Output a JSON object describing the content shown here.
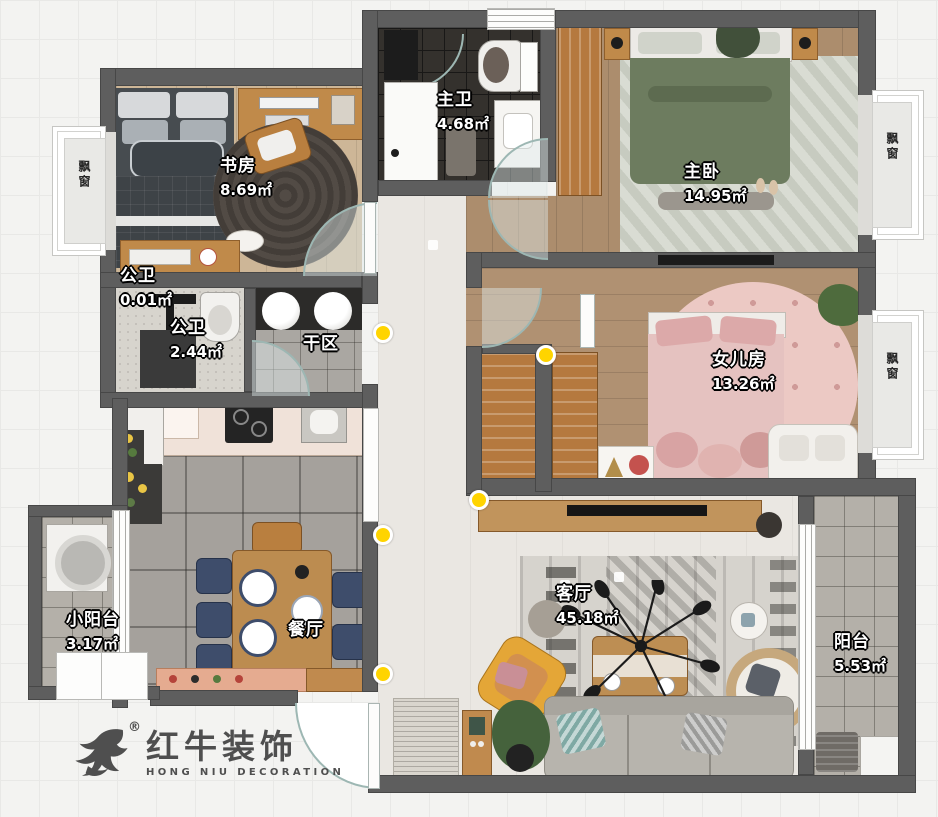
{
  "colors": {
    "wall": "#5e5e5e",
    "accent_dot": "#ffd400",
    "logo": "#4f4f4f",
    "door_glass": "#9db7b3"
  },
  "logo": {
    "brand_cn": "红牛装饰",
    "brand_en": "HONG NIU DECORATION",
    "registered": "®"
  },
  "rooms": [
    {
      "name": "study",
      "label": "书房",
      "area": "8.69㎡"
    },
    {
      "name": "master-bath",
      "label": "主卫",
      "area": "4.68㎡"
    },
    {
      "name": "master-bedroom",
      "label": "主卧",
      "area": "14.95㎡"
    },
    {
      "name": "guest-bath-small",
      "label": "公卫",
      "area": "0.01㎡"
    },
    {
      "name": "guest-bath",
      "label": "公卫",
      "area": "2.44㎡"
    },
    {
      "name": "dry-area",
      "label": "干区",
      "area": ""
    },
    {
      "name": "daughter-room",
      "label": "女儿房",
      "area": "13.26㎡"
    },
    {
      "name": "small-balcony",
      "label": "小阳台",
      "area": "3.17㎡"
    },
    {
      "name": "dining-room",
      "label": "餐厅",
      "area": ""
    },
    {
      "name": "living-room",
      "label": "客厅",
      "area": "45.18㎡"
    },
    {
      "name": "balcony",
      "label": "阳台",
      "area": "5.53㎡"
    }
  ],
  "bay_windows": [
    {
      "label": "飘窗"
    },
    {
      "label": "飘窗"
    },
    {
      "label": "飘窗"
    }
  ]
}
